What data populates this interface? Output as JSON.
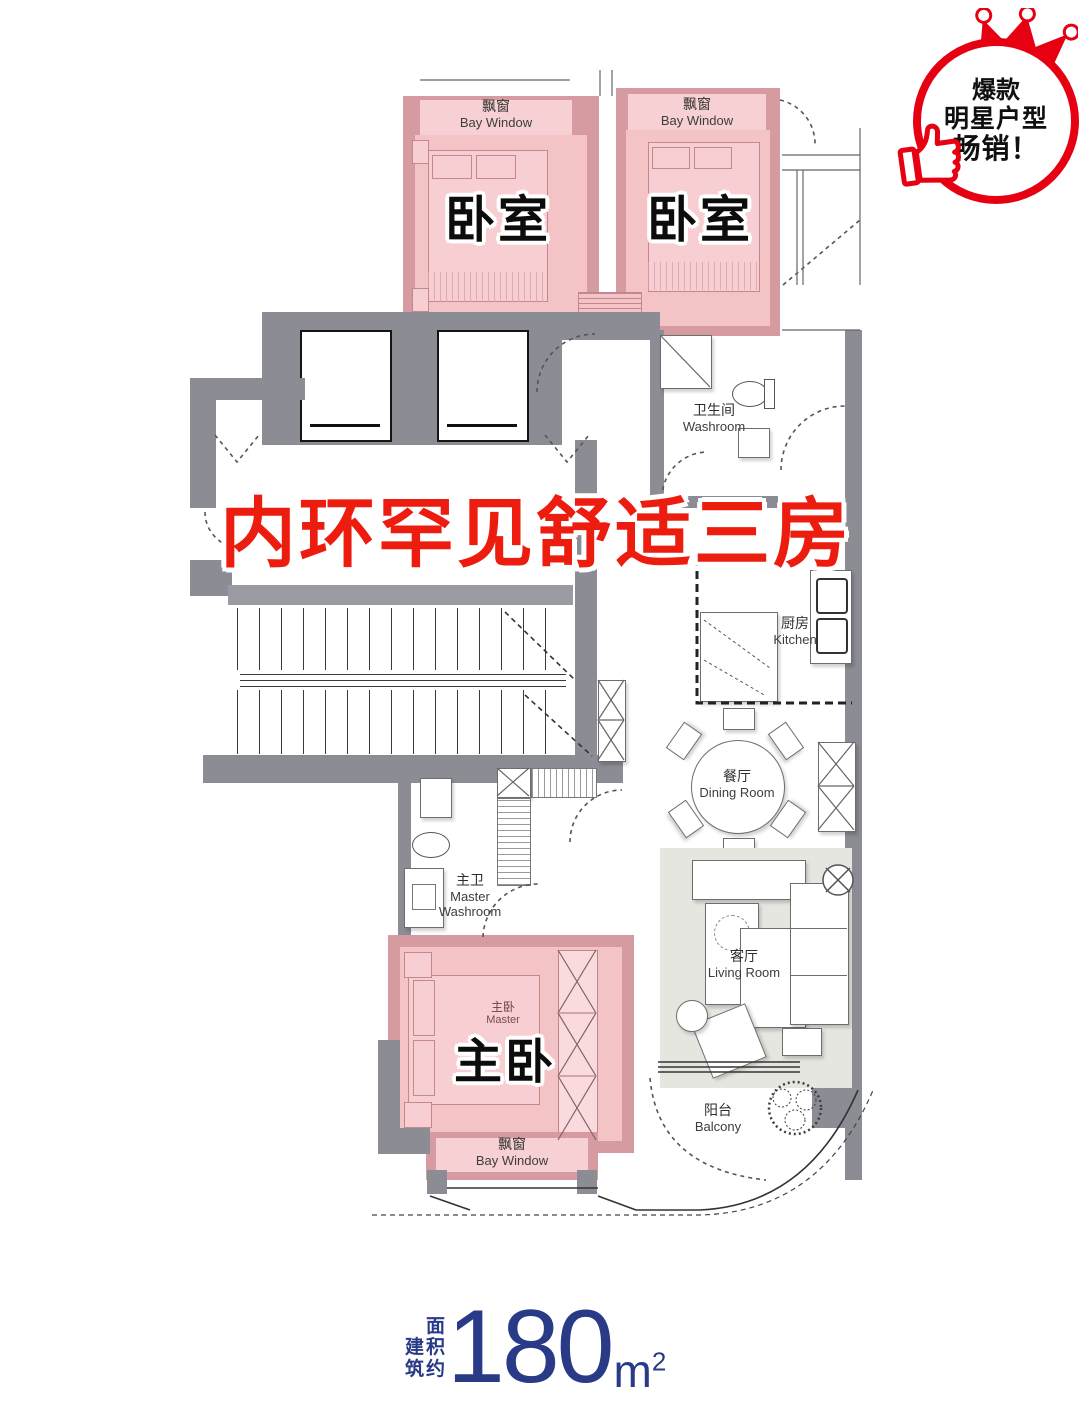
{
  "badge": {
    "line1": "爆款",
    "line2": "明星户型",
    "line3": "畅销！",
    "accent": "#e60012"
  },
  "headline": {
    "text": "内环罕见舒适三房",
    "color": "#ec1c0f"
  },
  "plan": {
    "bedroom1": {
      "label": "卧室"
    },
    "bedroom2": {
      "label": "卧室"
    },
    "master_bedroom": {
      "label": "主卧",
      "small_zh": "主卧",
      "small_en": "Master"
    },
    "bay_window": {
      "zh": "飘窗",
      "en": "Bay Window"
    },
    "washroom": {
      "zh": "卫生间",
      "en": "Washroom"
    },
    "kitchen": {
      "zh": "厨房",
      "en": "Kitchen"
    },
    "dining_room": {
      "zh": "餐厅",
      "en": "Dining Room"
    },
    "living_room": {
      "zh": "客厅",
      "en": "Living Room"
    },
    "master_washroom": {
      "zh": "主卫",
      "en_line1": "Master",
      "en_line2": "Washroom"
    },
    "balcony": {
      "zh": "阳台",
      "en": "Balcony"
    }
  },
  "area": {
    "label_col1": "建筑",
    "label_col2": "面积约",
    "value": "180",
    "unit": "m",
    "unit_exponent": "2",
    "color": "#293a87"
  },
  "colors": {
    "wall_grey": "#8c8c94",
    "room_pink": "#f4c3c6",
    "pink_wall": "#d69ba0",
    "bay_pink": "#f7d0d3",
    "highlight_red": "#ec1c0f",
    "navy": "#293a87"
  }
}
